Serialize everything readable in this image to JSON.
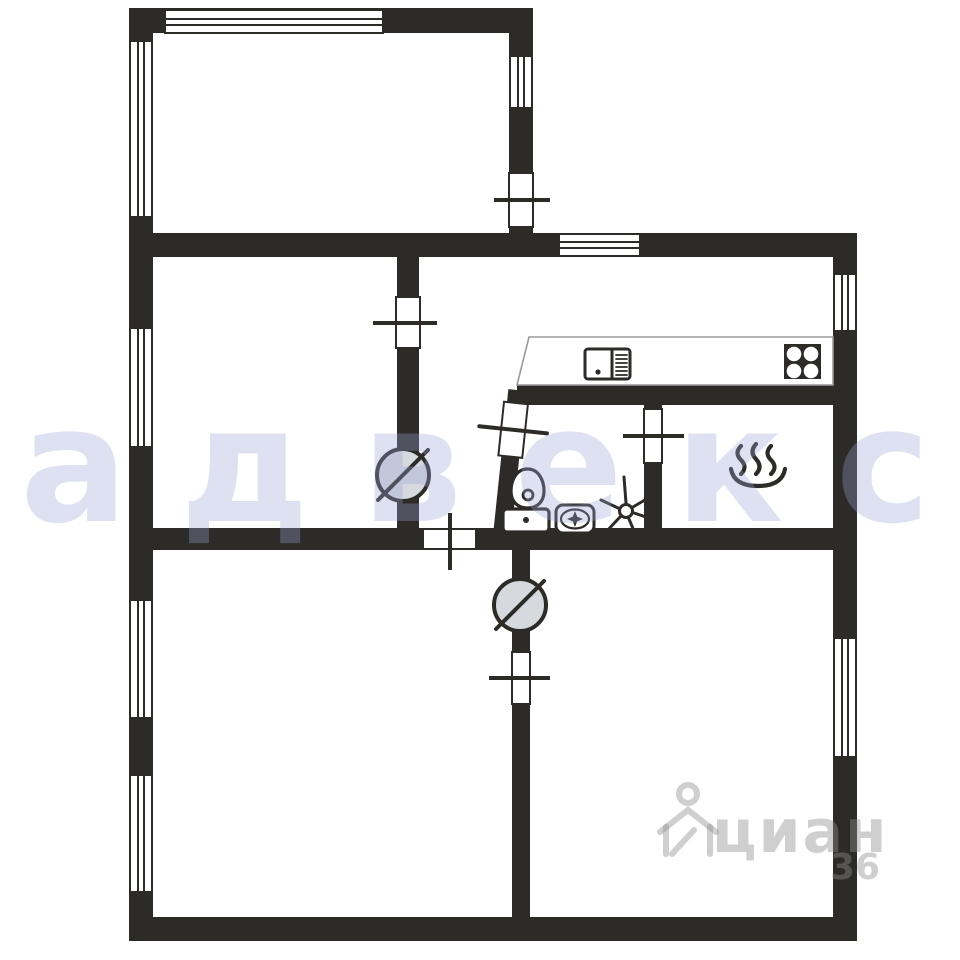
{
  "plan": {
    "kind": "apartment floor plan",
    "rooms_visible_text": [],
    "fixtures": [
      {
        "icon": "stove-icon",
        "meaning": "4-burner cooktop in kitchen"
      },
      {
        "icon": "kitchen-sink-icon",
        "meaning": "kitchen sink with drainboard on counter"
      },
      {
        "icon": "hot-water-icon",
        "meaning": "steam-over-basin symbol (bath / hot water room)"
      },
      {
        "icon": "toilet-icon",
        "meaning": "toilet with tank, bathroom"
      },
      {
        "icon": "washbasin-icon",
        "meaning": "washbasin with sparkle drain, bathroom"
      },
      {
        "icon": "fan-icon",
        "meaning": "asterisk fan/vent symbol, bathroom"
      },
      {
        "icon": "door-pivot-icon",
        "meaning": "circle with diagonal slash on interior walls (x2)"
      },
      {
        "icon": "window-hatch",
        "meaning": "striped wall openings = windows (x9)"
      },
      {
        "icon": "cian-pin-icon",
        "meaning": "portal watermark house/pin logo"
      }
    ]
  },
  "watermarks": {
    "agency_text": "адвекс",
    "portal_text": "циан",
    "portal_number": "36"
  },
  "colors": {
    "wall": "#2d2b28",
    "floor": "#ffffff",
    "circle_fill": "#d6d9de",
    "counter_outline": "#9a9a9a",
    "agency_tint": "rgba(156,165,213,0.33)",
    "portal_tint": "rgba(140,140,140,0.42)"
  }
}
